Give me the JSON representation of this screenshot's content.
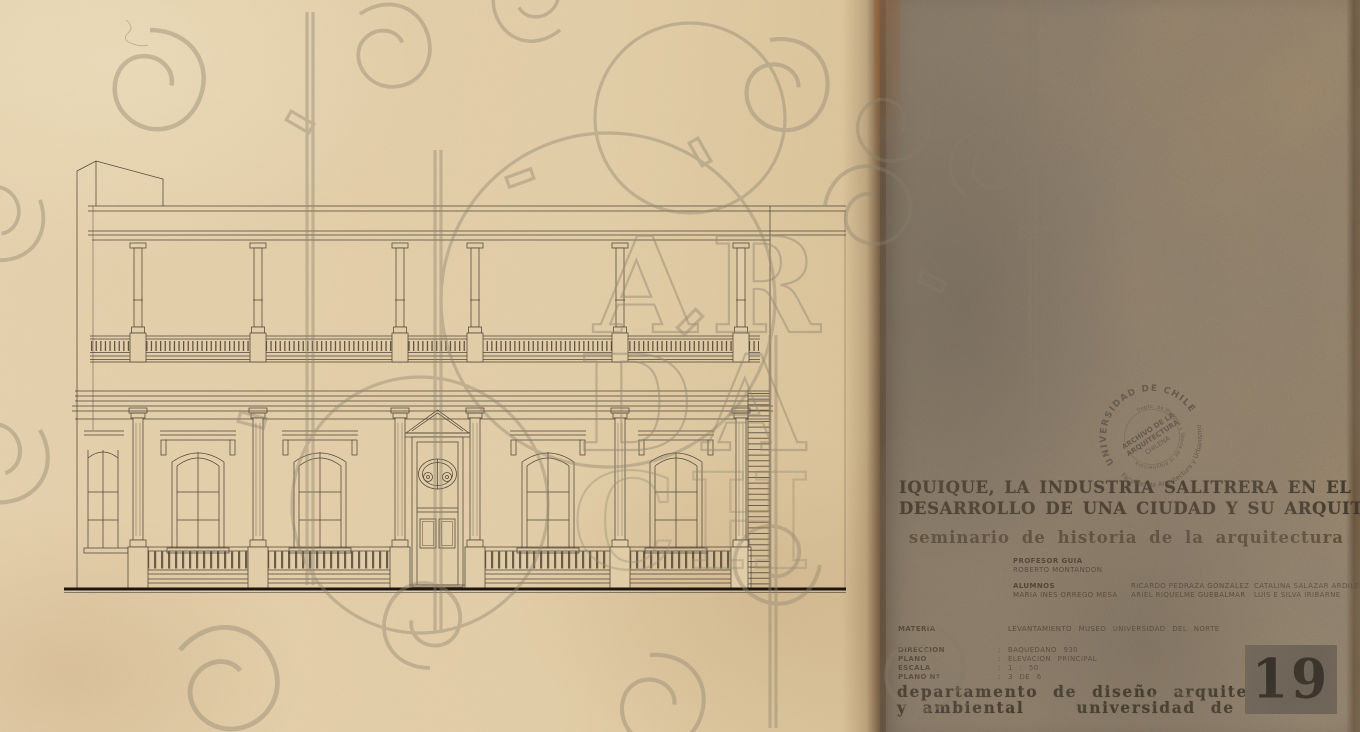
{
  "sheet": {
    "header": {
      "title_line1": "IQUIQUE, LA INDUSTRIA SALITRERA EN EL ORIGEN Y",
      "title_line2": "DESARROLLO DE UNA CIUDAD Y SU ARQUITECTURA",
      "subtitle": "seminario de historia de la arquitectura"
    },
    "credits": {
      "professor_label": "PROFESOR GUIA",
      "professor_name": "ROBERTO MONTANDON",
      "students_label": "ALUMNOS",
      "student_1": "MARIA INES ORREGO MESA",
      "student_2": "RICARDO PEDRAZA GONZALEZ",
      "student_3": "ARIEL RIQUELME GUEBALMAR",
      "student_4": "CATALINA SALAZAR ARDILES",
      "student_5": "LUIS E SILVA IRIBARNE"
    },
    "info_rows": [
      {
        "label": "MATERIA",
        "sep": "",
        "value": "LEVANTAMIENTO MUSEO UNIVERSIDAD DEL NORTE"
      },
      {
        "label": "DIRECCION",
        "sep": ":",
        "value": "BAQUEDANO 930"
      },
      {
        "label": "PLANO",
        "sep": ":",
        "value": "ELEVACION PRINCIPAL"
      },
      {
        "label": "ESCALA",
        "sep": ":",
        "value": "1 : 50"
      },
      {
        "label": "PLANO Nº",
        "sep": ":",
        "value": "3 DE 6"
      }
    ],
    "footer": {
      "department_line1": "departamento de diseño arquitectónico",
      "department_line2_left": "y ambiental",
      "department_line2_right": "universidad de chile",
      "sheet_number": "19"
    },
    "stamp": {
      "ring_top": "UNIVERSIDAD DE CHILE",
      "ring_bottom": "Facultad de Arquitectura y Urbanismo",
      "ring_inner": "Depto. de Historia y Teoría de la Arquitectura",
      "center_line1": "ARCHIVO DE LA",
      "center_line2": "ARQUITECTURA",
      "center_line3": "CHILENA"
    },
    "watermark": {
      "row1": "AR",
      "row2": "DA",
      "row3": "CH"
    },
    "colors": {
      "paper_left": "#ead5ae",
      "paper_right": "#a29179",
      "ink": "#4f4538",
      "title_ink": "#2b2114",
      "number_box": "#6b6158"
    }
  }
}
